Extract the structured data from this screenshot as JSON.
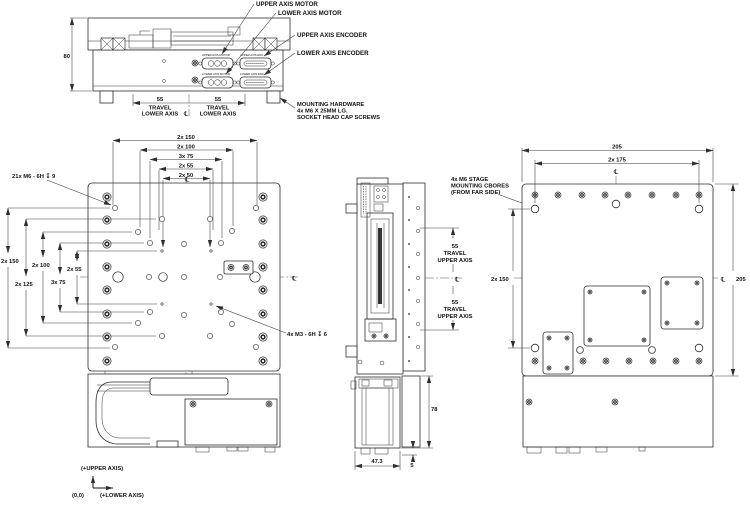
{
  "front_view": {
    "callouts": {
      "upper_motor": "UPPER AXIS MOTOR",
      "lower_motor": "LOWER AXIS MOTOR",
      "upper_encoder": "UPPER AXIS ENCODER",
      "lower_encoder": "LOWER AXIS ENCODER",
      "mounting_hw1": "MOUNTING HARDWARE",
      "mounting_hw2": "4x M6 X 25MM LG.",
      "mounting_hw3": "SOCKET HEAD CAP SCREWS"
    },
    "connector_labels": {
      "upper_motor": "UPPER AXIS MOTOR",
      "upper_enc": "UPPER AXIS ENC.",
      "lower_motor": "LOWER AXIS MOTOR",
      "lower_enc": "LOWER AXIS ENC."
    },
    "dims": {
      "height": "80",
      "travel_value": "55",
      "travel_word": "TRAVEL",
      "travel_axis": "LOWER AXIS"
    }
  },
  "plan_view": {
    "dims_top": [
      "2x 150",
      "2x 100",
      "3x 75",
      "2x 55",
      "2x 50"
    ],
    "dims_left": [
      "2x 150",
      "2x 125",
      "2x 100",
      "3x 75",
      "2x 55"
    ],
    "callout_m6": "21x M6 - 6H ↧ 9",
    "callout_m3": "4x M3 - 6H ↧ 6"
  },
  "side_view": {
    "travel_value": "55",
    "travel_word": "TRAVEL",
    "travel_axis": "UPPER AXIS",
    "dim_height": "78",
    "dim_foot": "5",
    "dim_width": "47.3",
    "callout_cbores1": "4x M6 STAGE",
    "callout_cbores2": "MOUNTING CBORES",
    "callout_cbores3": "(FROM FAR SIDE)"
  },
  "right_view": {
    "dim_width": "205",
    "dim_cbores": "2x 175",
    "dim_left": "2x 150",
    "dim_height": "205"
  },
  "axis_icon": {
    "up": "(+UPPER AXIS)",
    "origin": "(0,0)",
    "right": "(+LOWER AXIS)"
  },
  "symbols": {
    "centerline": "℄"
  }
}
